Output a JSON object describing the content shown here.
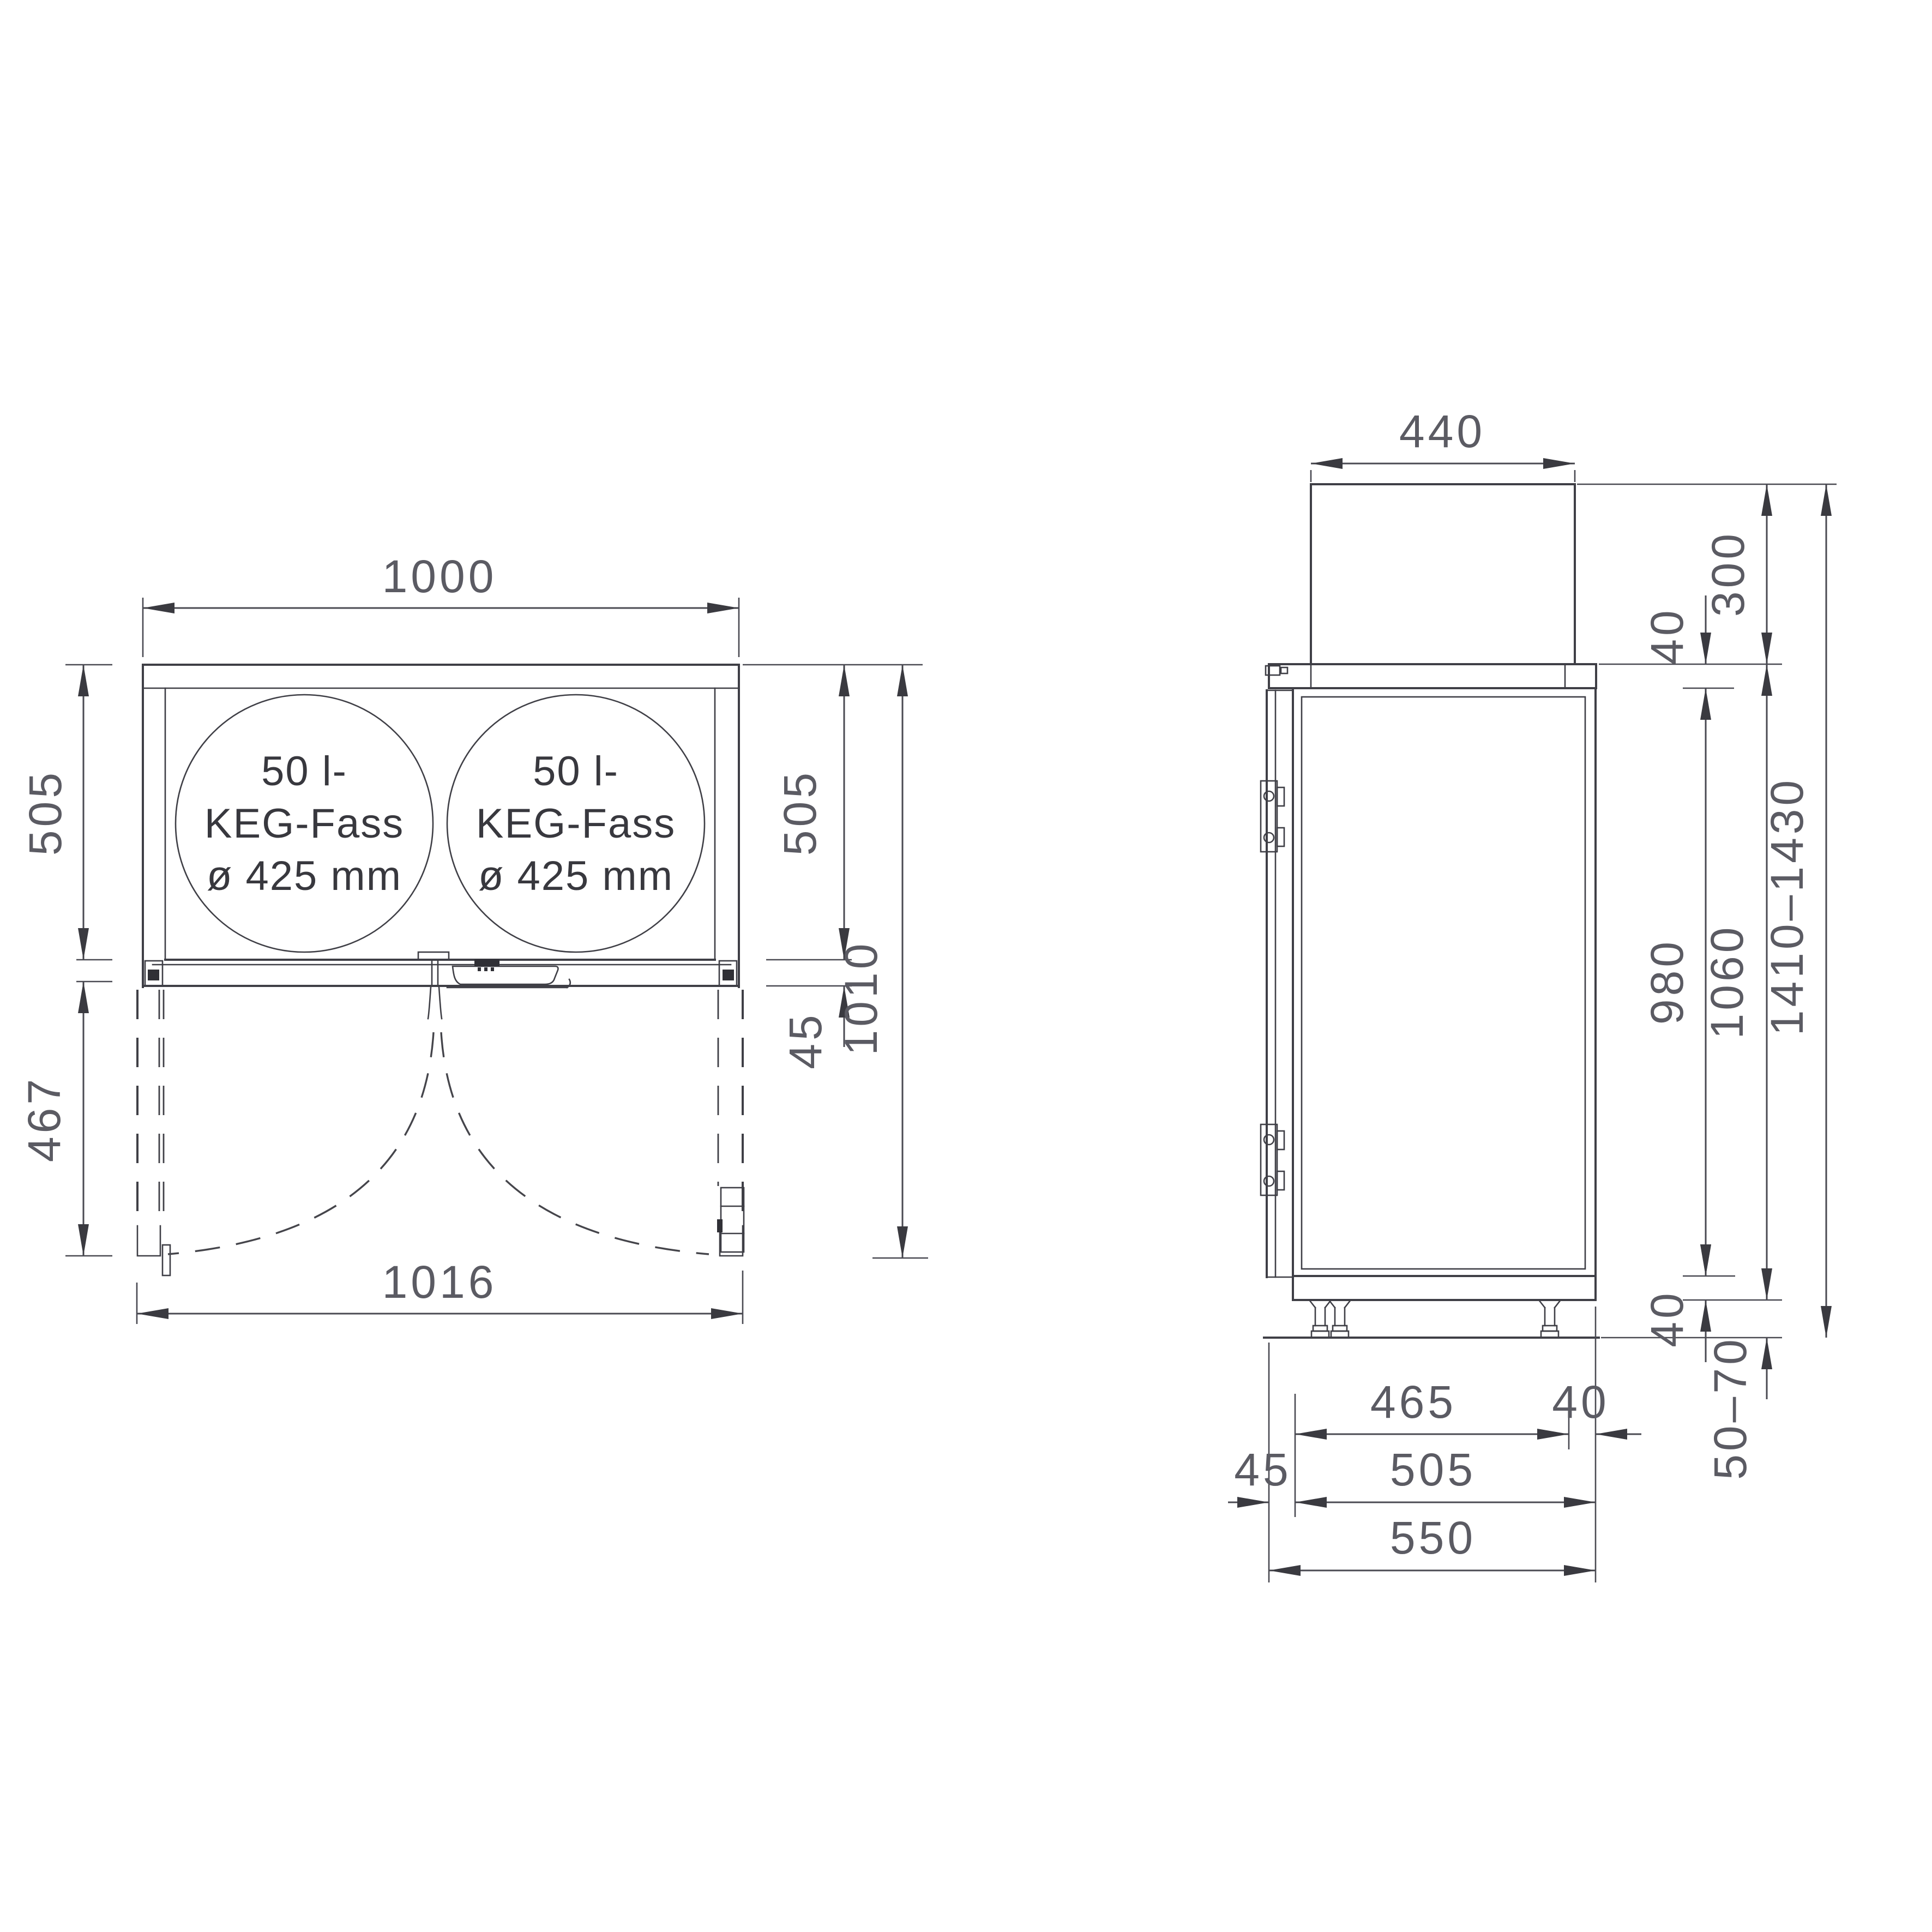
{
  "plan": {
    "width_top": "1000",
    "depth_left": "505",
    "door_swing": "467",
    "depth_right": "505",
    "front_gap": "45",
    "depth_total": "1010",
    "width_open": "1016"
  },
  "keg": {
    "line1": "50 l-",
    "line2": "KEG-Fass",
    "line3": "ø 425 mm"
  },
  "side": {
    "keg_width": "440",
    "keg_height": "300",
    "lid_thickness": "40",
    "door_height": "980",
    "base_height": "40",
    "body_height": "1060",
    "total_height": "1410–1430",
    "feet_range": "50–70",
    "interior_depth": "465",
    "back_gap": "40",
    "door_thickness": "45",
    "body_depth": "505",
    "total_depth": "550"
  }
}
